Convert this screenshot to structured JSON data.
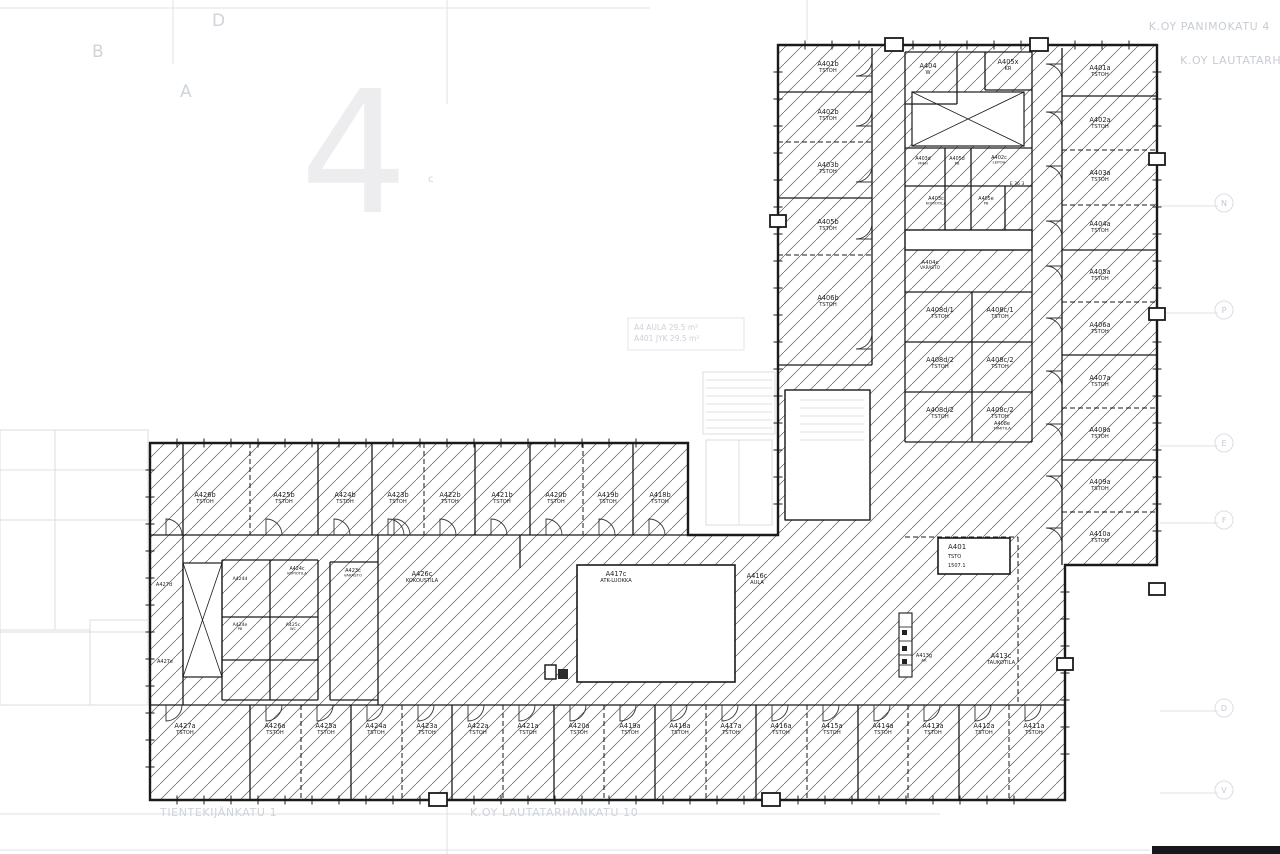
{
  "colors": {
    "wall": "#1a1a1a",
    "hatch": "#5a5a5a",
    "label": "#1c1c1c",
    "faint": "#c9ced6",
    "faint_line": "#dde1e6",
    "bg": "#ffffff"
  },
  "corner_texts": {
    "top_right_line1": "K.OY PANIMOKATU 4",
    "top_right_line2": "K.OY LAUTATARHANKA",
    "bottom_left": "TIENTEKIJÄNKATU 1",
    "bottom_center": "K.OY LAUTATARHANKATU 10"
  },
  "background": {
    "watermark": "4",
    "letters": [
      {
        "t": "B",
        "x": 92,
        "y": 57,
        "size": 17
      },
      {
        "t": "D",
        "x": 212,
        "y": 26,
        "size": 17
      },
      {
        "t": "A",
        "x": 180,
        "y": 97,
        "size": 17
      },
      {
        "t": "c",
        "x": 428,
        "y": 182,
        "size": 10
      }
    ],
    "grid_markers": [
      {
        "t": "N",
        "y": 206
      },
      {
        "t": "P",
        "y": 313
      },
      {
        "t": "E",
        "y": 446
      },
      {
        "t": "F",
        "y": 523
      },
      {
        "t": "D",
        "y": 711
      },
      {
        "t": "V",
        "y": 793
      }
    ]
  },
  "area_note": {
    "line1": "A4  AULA  29.5 m²",
    "line2": "A401  JYK  29.5 m²"
  },
  "title_box": {
    "line1": "A401",
    "line2": "TSTO",
    "line3": "1507.1"
  },
  "rooms_top_left": [
    {
      "label": "A401b",
      "sub": "TSTOH",
      "x": 828,
      "y": 66
    },
    {
      "label": "A402b",
      "sub": "TSTOH",
      "x": 828,
      "y": 114
    },
    {
      "label": "A403b",
      "sub": "TSTOH",
      "x": 828,
      "y": 167
    },
    {
      "label": "A405b",
      "sub": "TSTOH",
      "x": 828,
      "y": 224
    },
    {
      "label": "A406b",
      "sub": "TSTOH",
      "x": 828,
      "y": 300
    }
  ],
  "rooms_top_right": [
    {
      "label": "A401a",
      "sub": "TSTOH",
      "x": 1100,
      "y": 70
    },
    {
      "label": "A402a",
      "sub": "TSTOH",
      "x": 1100,
      "y": 122
    },
    {
      "label": "A403a",
      "sub": "TSTOH",
      "x": 1100,
      "y": 175
    },
    {
      "label": "A404a",
      "sub": "TSTOH",
      "x": 1100,
      "y": 226
    },
    {
      "label": "A405a",
      "sub": "TSTOH",
      "x": 1100,
      "y": 274
    },
    {
      "label": "A406a",
      "sub": "TSTOH",
      "x": 1100,
      "y": 327
    },
    {
      "label": "A407a",
      "sub": "TSTOH",
      "x": 1100,
      "y": 380
    },
    {
      "label": "A408a",
      "sub": "TSTOH",
      "x": 1100,
      "y": 432
    },
    {
      "label": "A409a",
      "sub": "TSTOH",
      "x": 1100,
      "y": 484
    },
    {
      "label": "A410a",
      "sub": "TSTOH",
      "x": 1100,
      "y": 536
    }
  ],
  "rooms_top_mid": [
    {
      "label": "A404",
      "sub": "W",
      "x": 928,
      "y": 68
    },
    {
      "label": "A405x",
      "sub": "KR",
      "x": 1008,
      "y": 64
    },
    {
      "label": "A403d",
      "sub": "MIEH",
      "x": 923,
      "y": 160,
      "size": 4.8
    },
    {
      "label": "A405d",
      "sub": "PB",
      "x": 957,
      "y": 160,
      "size": 4.8
    },
    {
      "label": "A402c",
      "sub": "LEPOH",
      "x": 999,
      "y": 159,
      "size": 5
    },
    {
      "label": "A403c",
      "sub": "KOPIOTILA",
      "x": 936,
      "y": 200,
      "size": 5
    },
    {
      "label": "A405e",
      "sub": "PB",
      "x": 986,
      "y": 200,
      "size": 4.8
    },
    {
      "label": "A404c",
      "sub": "VARASTO",
      "x": 930,
      "y": 264,
      "size": 5.5
    },
    {
      "label": "A408d/1",
      "sub": "TSTOH",
      "x": 940,
      "y": 312
    },
    {
      "label": "A408c/1",
      "sub": "TSTOH",
      "x": 1000,
      "y": 312
    },
    {
      "label": "A408d/2",
      "sub": "TSTOH",
      "x": 940,
      "y": 362
    },
    {
      "label": "A408c/2",
      "sub": "TSTOH",
      "x": 1000,
      "y": 362
    },
    {
      "label": "A408d/2",
      "sub": "TSTOH",
      "x": 940,
      "y": 412
    },
    {
      "label": "A408c/2",
      "sub": "TSTOH",
      "x": 1000,
      "y": 412
    }
  ],
  "rooms_row_top": [
    {
      "label": "A426b",
      "sub": "TSTOH",
      "x": 205,
      "y": 497
    },
    {
      "label": "A425b",
      "sub": "TSTOH",
      "x": 284,
      "y": 497
    },
    {
      "label": "A424b",
      "sub": "TSTOH",
      "x": 345,
      "y": 497
    },
    {
      "label": "A423b",
      "sub": "TSTOH",
      "x": 398,
      "y": 497
    },
    {
      "label": "A422b",
      "sub": "TSTOH",
      "x": 450,
      "y": 497
    },
    {
      "label": "A421b",
      "sub": "TSTOH",
      "x": 502,
      "y": 497
    },
    {
      "label": "A420b",
      "sub": "TSTOH",
      "x": 556,
      "y": 497
    },
    {
      "label": "A419b",
      "sub": "TSTOH",
      "x": 608,
      "y": 497
    },
    {
      "label": "A418b",
      "sub": "TSTOH",
      "x": 660,
      "y": 497
    }
  ],
  "rooms_row_bottom": [
    {
      "label": "A427a",
      "sub": "TSTOH",
      "x": 185,
      "y": 728
    },
    {
      "label": "A426a",
      "sub": "TSTOH",
      "x": 275,
      "y": 728
    },
    {
      "label": "A425a",
      "sub": "TSTOH",
      "x": 326,
      "y": 728
    },
    {
      "label": "A424a",
      "sub": "TSTOH",
      "x": 376,
      "y": 728
    },
    {
      "label": "A423a",
      "sub": "TSTOH",
      "x": 427,
      "y": 728
    },
    {
      "label": "A422a",
      "sub": "TSTOH",
      "x": 478,
      "y": 728
    },
    {
      "label": "A421a",
      "sub": "TSTOH",
      "x": 528,
      "y": 728
    },
    {
      "label": "A420a",
      "sub": "TSTOH",
      "x": 579,
      "y": 728
    },
    {
      "label": "A419a",
      "sub": "TSTOH",
      "x": 630,
      "y": 728
    },
    {
      "label": "A418a",
      "sub": "TSTOH",
      "x": 680,
      "y": 728
    },
    {
      "label": "A417a",
      "sub": "TSTOH",
      "x": 731,
      "y": 728
    },
    {
      "label": "A416a",
      "sub": "TSTOH",
      "x": 781,
      "y": 728
    },
    {
      "label": "A415a",
      "sub": "TSTOH",
      "x": 832,
      "y": 728
    },
    {
      "label": "A414a",
      "sub": "TSTOH",
      "x": 883,
      "y": 728
    },
    {
      "label": "A413a",
      "sub": "TSTOH",
      "x": 933,
      "y": 728
    },
    {
      "label": "A412a",
      "sub": "TSTOH",
      "x": 984,
      "y": 728
    },
    {
      "label": "A411a",
      "sub": "TSTOH",
      "x": 1034,
      "y": 728
    }
  ],
  "open_labels": [
    {
      "label": "A416c",
      "sub": "AULA",
      "x": 757,
      "y": 578
    },
    {
      "label": "A417c",
      "sub": "ATK-LUOKKA",
      "x": 616,
      "y": 576
    },
    {
      "label": "A426c",
      "sub": "KOKOUSTILA",
      "x": 422,
      "y": 576
    },
    {
      "label": "A423c",
      "sub": "VARASTO",
      "x": 353,
      "y": 572,
      "size": 5
    },
    {
      "label": "A424c",
      "sub": "KOPIOTILA",
      "x": 297,
      "y": 570,
      "size": 4.8
    },
    {
      "label": "A424d",
      "sub": "",
      "x": 240,
      "y": 580,
      "size": 4.6
    },
    {
      "label": "A424e",
      "sub": "PB",
      "x": 240,
      "y": 626,
      "size": 4.6
    },
    {
      "label": "A425c",
      "sub": "WC",
      "x": 293,
      "y": 626,
      "size": 4.6
    },
    {
      "label": "A427d",
      "sub": "",
      "x": 164,
      "y": 586,
      "size": 5
    },
    {
      "label": "A427e",
      "sub": "",
      "x": 165,
      "y": 663,
      "size": 5
    },
    {
      "label": "A413g",
      "sub": "AK",
      "x": 924,
      "y": 657,
      "size": 5
    },
    {
      "label": "A413c",
      "sub": "TAUKOTILA",
      "x": 1001,
      "y": 658
    },
    {
      "label": "A408e",
      "sub": "TIIMITILA",
      "x": 1002,
      "y": 425,
      "size": 5
    },
    {
      "label": "E 36 3",
      "sub": "",
      "x": 1017,
      "y": 185,
      "size": 4.6
    }
  ]
}
